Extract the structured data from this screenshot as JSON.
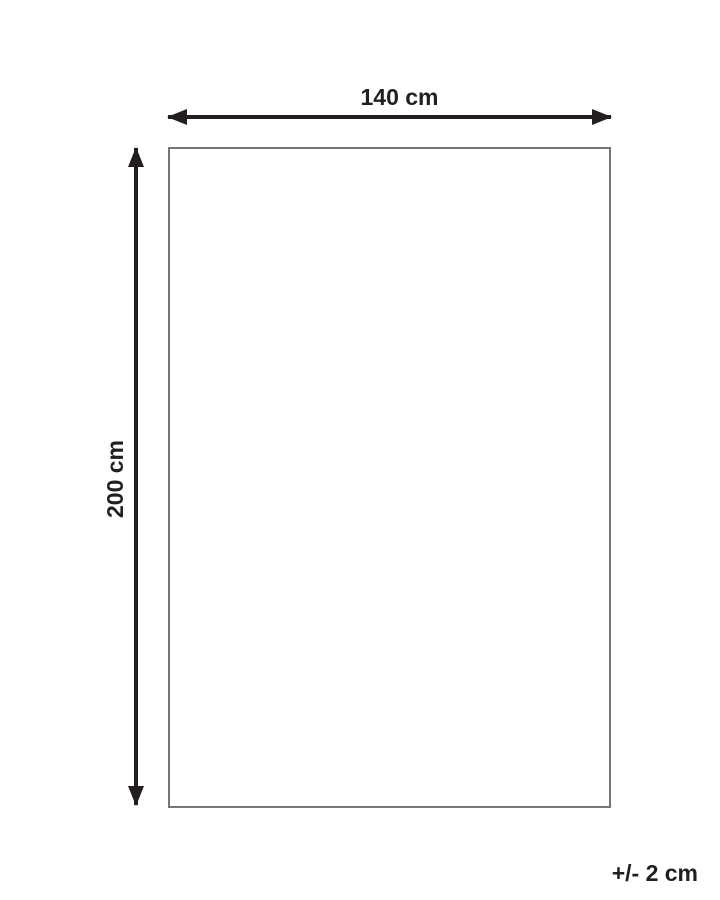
{
  "diagram": {
    "horizontal_dimension": {
      "label": "140 cm"
    },
    "vertical_dimension": {
      "label": "200 cm"
    },
    "tolerance": {
      "label": "+/- 2 cm"
    },
    "colors": {
      "dimension_line": "#231f20",
      "text": "#231f20",
      "rectangle_border": "#767676",
      "background": "#ffffff"
    }
  }
}
